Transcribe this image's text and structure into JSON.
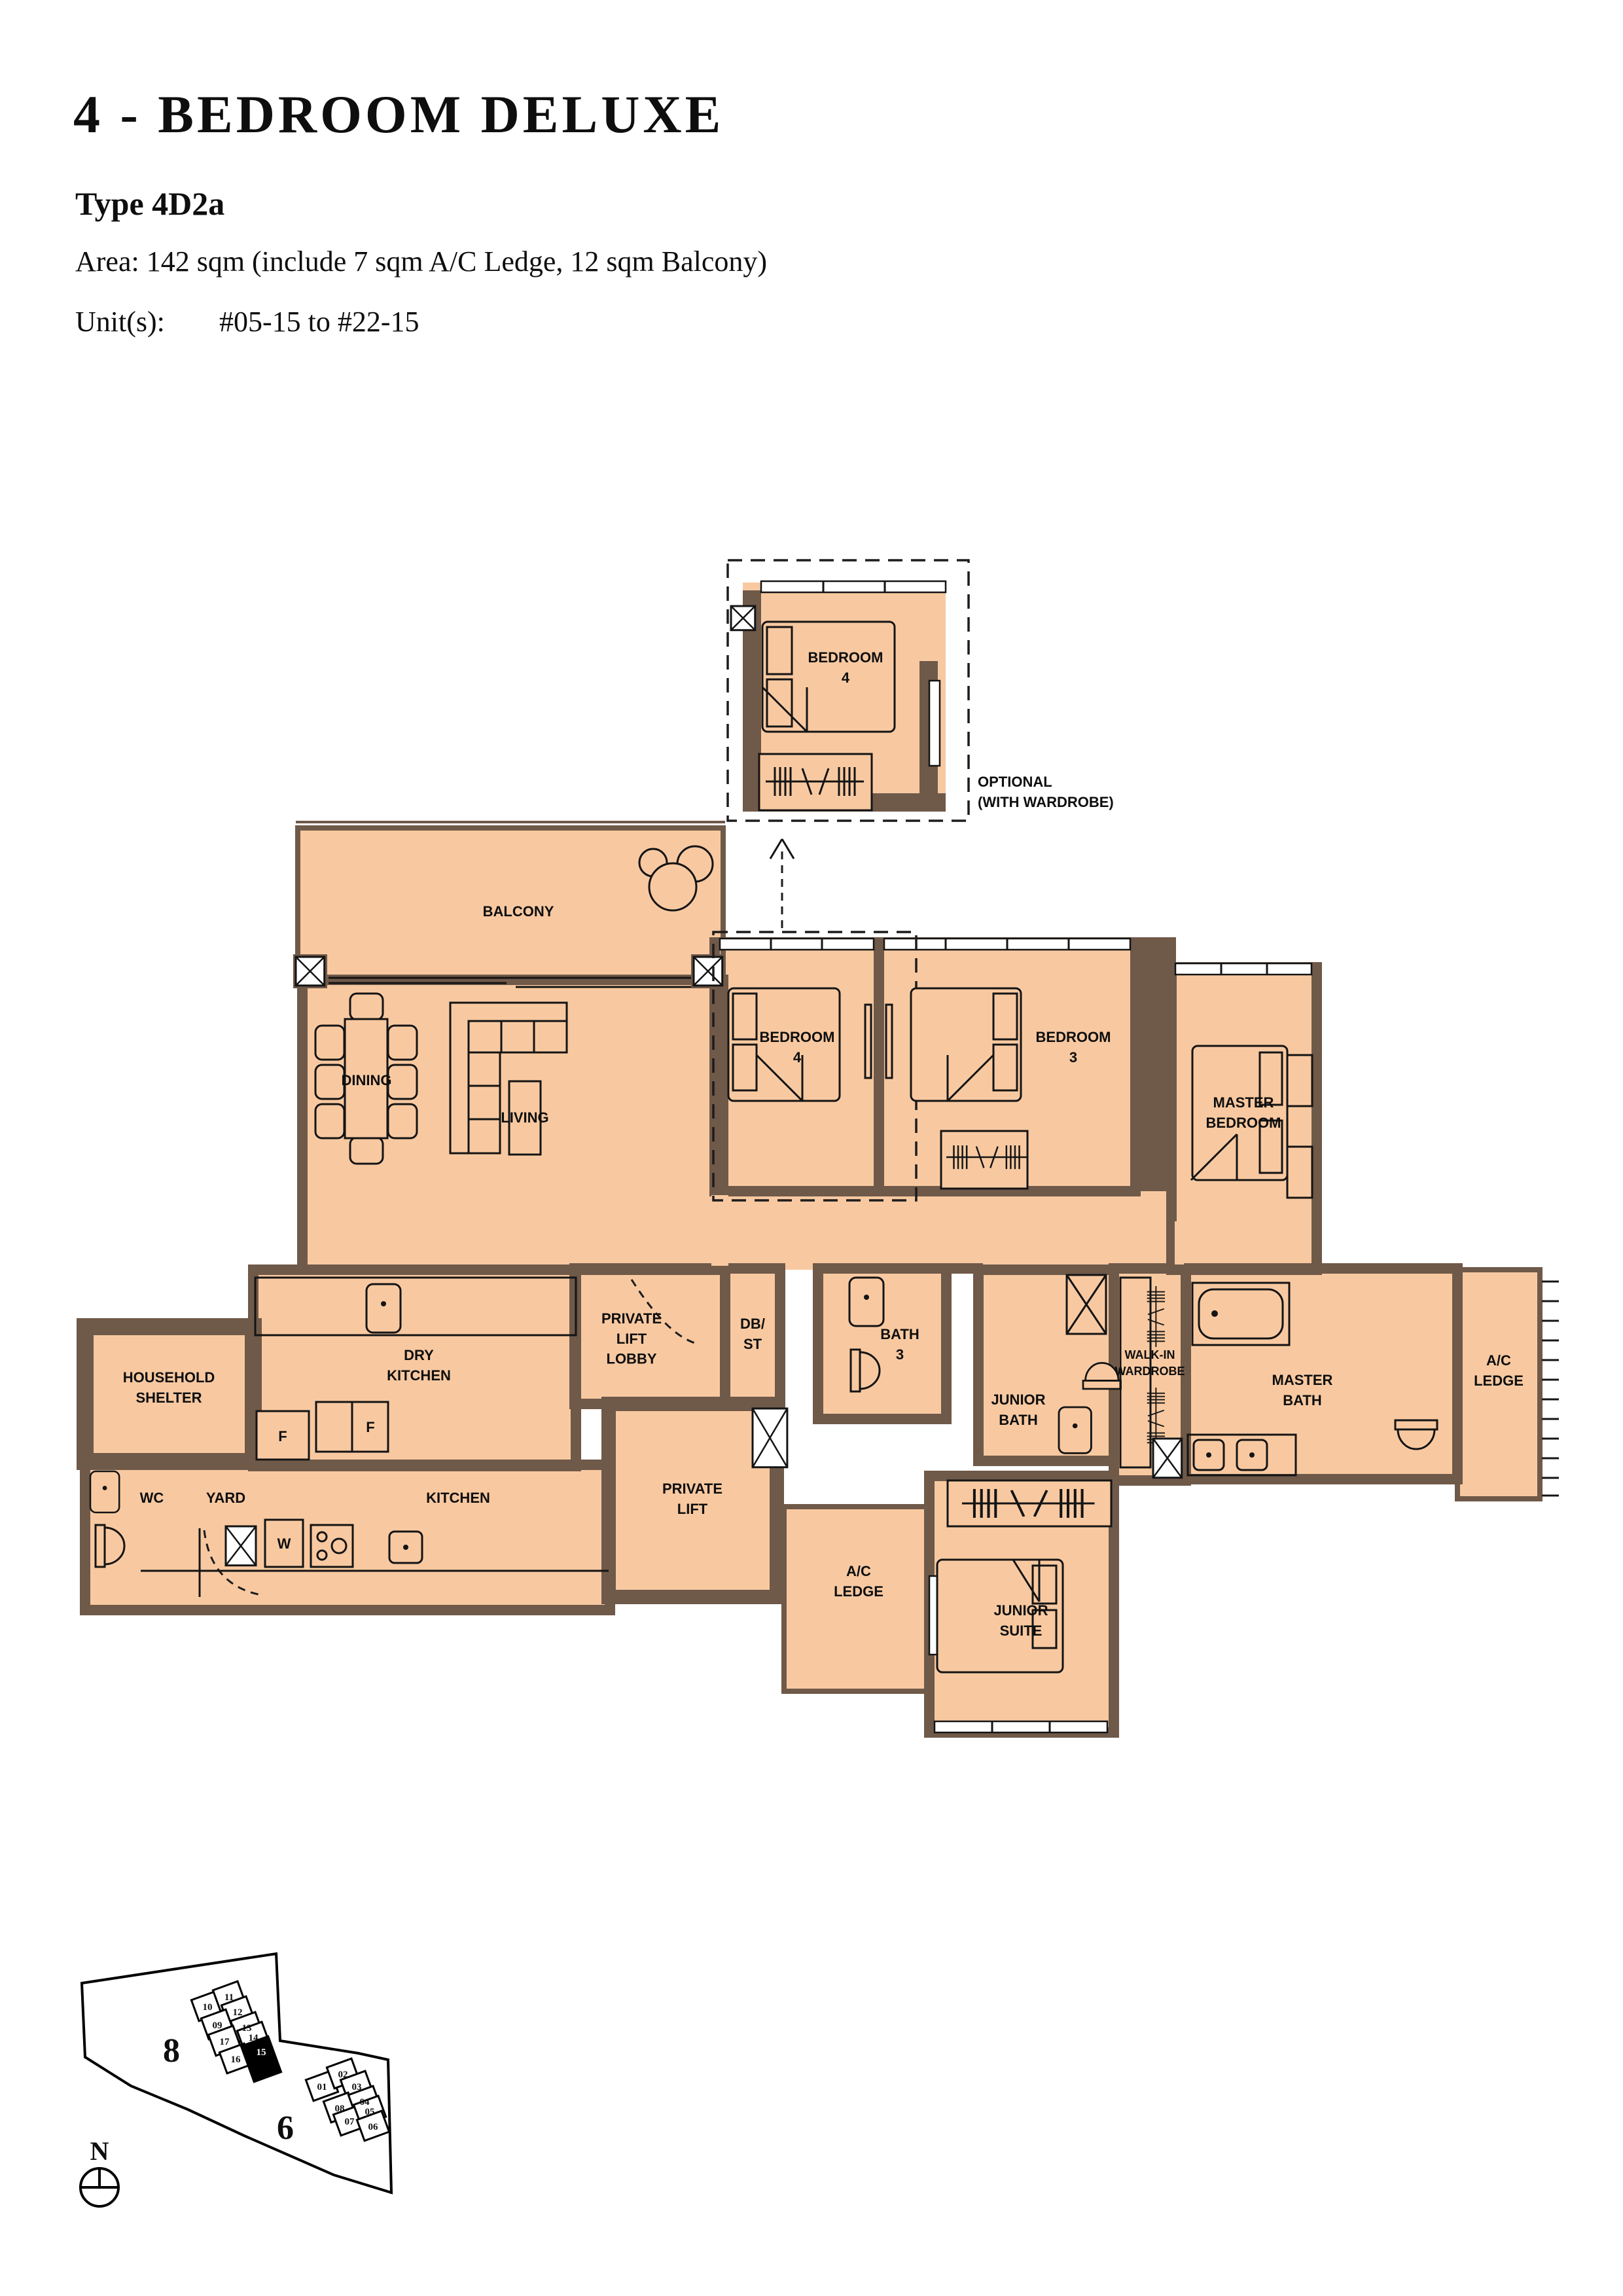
{
  "header": {
    "title": "4 - BEDROOM DELUXE",
    "type": "Type 4D2a",
    "area": "Area: 142 sqm (include 7 sqm A/C Ledge, 12 sqm Balcony)",
    "units_label": "Unit(s):",
    "units_value": "#05-15 to #22-15"
  },
  "floorplan": {
    "rooms": {
      "balcony": "BALCONY",
      "dining": "DINING",
      "living": "LIVING",
      "bedroom4": "BEDROOM\n4",
      "bedroom3": "BEDROOM\n3",
      "master_bedroom": "MASTER\nBEDROOM",
      "household_shelter": "HOUSEHOLD\nSHELTER",
      "dry_kitchen": "DRY\nKITCHEN",
      "wc": "WC",
      "yard": "YARD",
      "kitchen": "KITCHEN",
      "private_lift_lobby": "PRIVATE\nLIFT\nLOBBY",
      "db_st": "DB/\nST",
      "bath3": "BATH\n3",
      "private_lift": "PRIVATE\nLIFT",
      "ac_ledge": "A/C\nLEDGE",
      "junior_bath": "JUNIOR\nBATH",
      "walk_in_wardrobe": "WALK-IN\nWARDROBE",
      "master_bath": "MASTER\nBATH",
      "junior_suite": "JUNIOR\nSUITE"
    },
    "annotations": {
      "optional": "OPTIONAL\n(WITH WARDROBE)",
      "fridge": "F",
      "washer": "W"
    }
  },
  "site_plan": {
    "north": "N",
    "block8": {
      "label": "8",
      "units": [
        "10",
        "11",
        "12",
        "09",
        "13",
        "17",
        "14",
        "16",
        "15"
      ],
      "highlighted": "15"
    },
    "block6": {
      "label": "6",
      "units": [
        "01",
        "02",
        "03",
        "08",
        "04",
        "07",
        "05",
        "06"
      ]
    }
  }
}
